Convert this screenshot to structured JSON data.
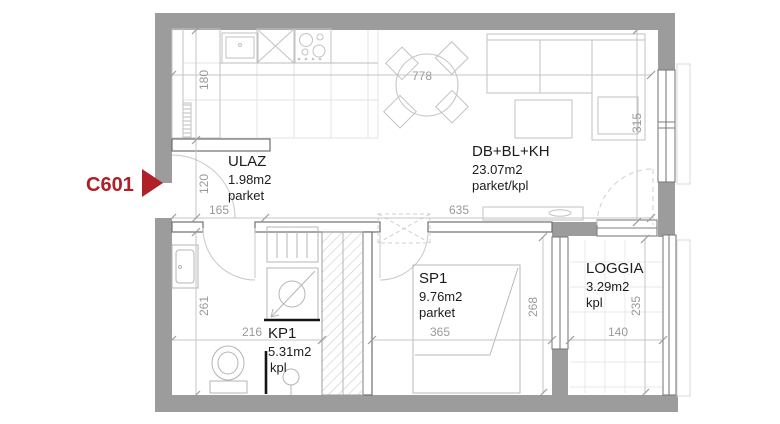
{
  "unit": {
    "code": "C601"
  },
  "rooms": [
    {
      "name": "ULAZ",
      "area": "1.98m2",
      "floor": "parket"
    },
    {
      "name": "DB+BL+KH",
      "area": "23.07m2",
      "floor": "parket/kpl"
    },
    {
      "name": "SP1",
      "area": "9.76m2",
      "floor": "parket"
    },
    {
      "name": "KP1",
      "area": "5.31m2",
      "floor": "kpl"
    },
    {
      "name": "LOGGIA",
      "area": "3.29m2",
      "floor": "kpl"
    }
  ],
  "dimensions": {
    "kitchen_depth": "180",
    "entry_depth": "120",
    "entry_width": "165",
    "living_width": "635",
    "living_total_width": "778",
    "living_depth": "315",
    "bath_depth": "261",
    "bath_width": "216",
    "bedroom_width": "365",
    "bedroom_depth": "268",
    "loggia_width": "140",
    "loggia_depth": "235"
  },
  "colors": {
    "wall": "#9c9c9c",
    "accent": "#b02028",
    "dim_text": "#9a9a9a"
  }
}
